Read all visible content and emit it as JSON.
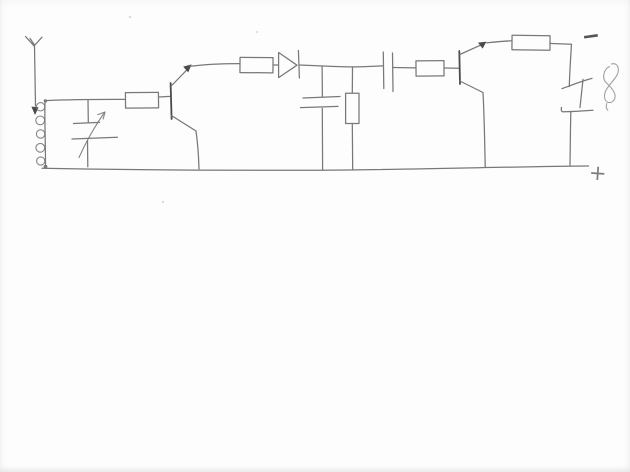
{
  "page": {
    "paper_color": "#fdfdfd",
    "ink": "#787878",
    "ink_dark": "#4a4a4a",
    "ink_light": "#a0a0a0"
  },
  "schematic": {
    "kind": "hand-drawn-two-transistor-radio-receiver-circuit",
    "labels": {
      "negative_terminal": "−",
      "positive_terminal": "+"
    },
    "components": [
      {
        "id": "antenna",
        "name": "antenna"
      },
      {
        "id": "tuning-coil",
        "name": "inductor-coil-5-turns"
      },
      {
        "id": "variable-capacitor",
        "name": "variable-tuning-capacitor-with-arrow"
      },
      {
        "id": "resistor-r1",
        "name": "series-resistor-stage1"
      },
      {
        "id": "transistor-q1",
        "name": "transistor-stage1"
      },
      {
        "id": "resistor-r2",
        "name": "series-resistor-detector"
      },
      {
        "id": "diode-d1",
        "name": "detector-diode"
      },
      {
        "id": "capacitor-c1",
        "name": "filter-capacitor-to-rail"
      },
      {
        "id": "resistor-r3",
        "name": "load-resistor-to-rail"
      },
      {
        "id": "capacitor-c2",
        "name": "coupling-capacitor"
      },
      {
        "id": "resistor-r4",
        "name": "base-resistor-stage2"
      },
      {
        "id": "transistor-q2",
        "name": "transistor-stage2"
      },
      {
        "id": "resistor-r5",
        "name": "collector-resistor-stage2"
      },
      {
        "id": "earphone",
        "name": "earphone-with-cord-squiggle"
      },
      {
        "id": "top-rail",
        "name": "negative-supply-rail"
      },
      {
        "id": "bottom-rail",
        "name": "positive-supply-rail"
      }
    ]
  }
}
